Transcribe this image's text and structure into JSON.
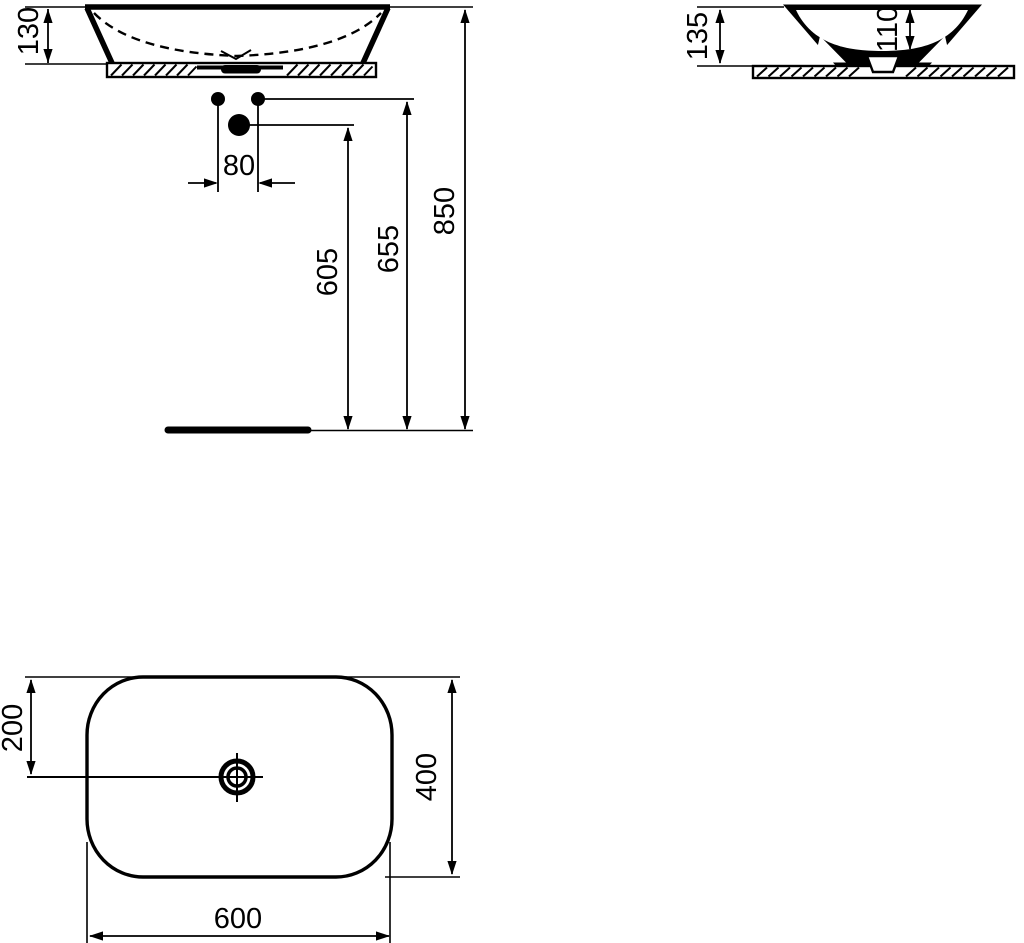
{
  "page": {
    "title": "Vessel washbasin dimensional drawing",
    "background": "#ffffff",
    "line_color": "#000000"
  },
  "views": {
    "front": {
      "dim_basin_height": "130",
      "dim_tap_hole_spacing": "80",
      "dim_outlet_height": "605",
      "dim_tap_hole_height": "655",
      "dim_rim_height": "850"
    },
    "side": {
      "dim_total_height": "135",
      "dim_bowl_depth": "110"
    },
    "plan": {
      "dim_center_offset": "200",
      "dim_depth": "400",
      "dim_width": "600"
    }
  }
}
